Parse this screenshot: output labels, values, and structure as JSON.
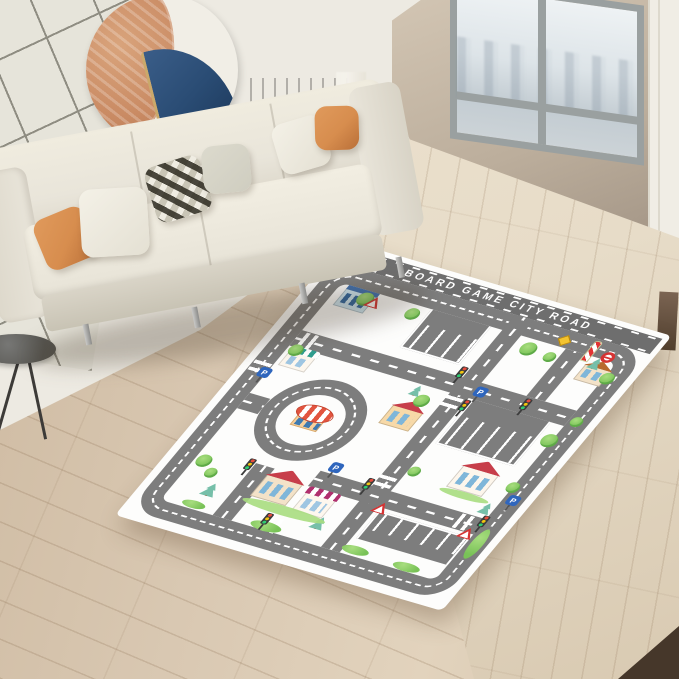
{
  "colors": {
    "wall": "#edeae2",
    "tile": "#e6e4da",
    "art_cream": "#f1eee6",
    "art_terracotta": "#c98a63",
    "art_navy": "#2a4c74",
    "marble": "#bcae9c",
    "window_frame": "#9aa0a0",
    "glass": "#dde4e8",
    "floor": "#d9c8b2",
    "floor_light": "#e7dcc8",
    "wood_dark": "#46372a",
    "sofa": "#e9e5da",
    "sofa_dark": "#d9d4c7",
    "pillow_orange": "#d78d4e",
    "pillow_gray": "#cfcdc0",
    "rug_bg": "#fdfdfc",
    "header": "#6e6e6e",
    "road": "#7d7d7d",
    "grass": "#79c257",
    "grass_light": "#a8dd7f",
    "sign_red": "#d63333",
    "sign_blue": "#2f66bd"
  },
  "rug": {
    "title": "BOARD GAME CITY ROAD",
    "items": [
      {
        "t": "car",
        "x": 14,
        "y": 9
      },
      {
        "t": "diamond",
        "x": 256,
        "y": 33
      },
      {
        "t": "pole",
        "x": 288,
        "y": 28
      },
      {
        "t": "noentry",
        "x": 304,
        "y": 36
      },
      {
        "t": "bldg",
        "x": 36,
        "y": 50,
        "w": 32,
        "h": 22
      },
      {
        "t": "shopA",
        "x": 32,
        "y": 132,
        "w": 28,
        "h": 20,
        "awn": "#2f9e8f"
      },
      {
        "t": "house",
        "x": 102,
        "y": 270,
        "w": 38,
        "h": 28,
        "roof": "#c73e4a",
        "body": "#f3e2c8"
      },
      {
        "t": "shopA",
        "x": 148,
        "y": 276,
        "w": 32,
        "h": 24,
        "awn": "#b0306e"
      },
      {
        "t": "house",
        "x": 160,
        "y": 158,
        "w": 32,
        "h": 24,
        "roof": "#c73e4a",
        "body": "#f7d9a8"
      },
      {
        "t": "house",
        "x": 264,
        "y": 200,
        "w": 38,
        "h": 28,
        "roof": "#c73e4a",
        "body": "#fdf6ec"
      },
      {
        "t": "house",
        "x": 296,
        "y": 56,
        "w": 28,
        "h": 20,
        "roof": "#b86a2e",
        "body": "#f3e2c8"
      },
      {
        "t": "zebraV",
        "x": 199,
        "y": 130,
        "w": 18,
        "h": 14
      },
      {
        "t": "zebraV",
        "x": 199,
        "y": 234,
        "w": 18,
        "h": 14
      },
      {
        "t": "zebraV",
        "x": 9,
        "y": 152,
        "w": 18,
        "h": 14
      },
      {
        "t": "zebraH",
        "x": 34,
        "y": 109,
        "w": 14,
        "h": 18
      },
      {
        "t": "zebraH",
        "x": 298,
        "y": 251,
        "w": 14,
        "h": 18
      },
      {
        "t": "zebraH",
        "x": 136,
        "y": 313,
        "w": 14,
        "h": 18
      },
      {
        "t": "tree",
        "x": 52,
        "y": 48,
        "s": 16
      },
      {
        "t": "tree",
        "x": 104,
        "y": 50,
        "s": 14
      },
      {
        "t": "tree",
        "x": 228,
        "y": 50,
        "s": 16
      },
      {
        "t": "tree",
        "x": 254,
        "y": 54,
        "s": 12
      },
      {
        "t": "tree",
        "x": 318,
        "y": 58,
        "s": 14
      },
      {
        "t": "tree",
        "x": 30,
        "y": 124,
        "s": 14
      },
      {
        "t": "tree",
        "x": 174,
        "y": 138,
        "s": 15
      },
      {
        "t": "tree",
        "x": 312,
        "y": 140,
        "s": 16
      },
      {
        "t": "tree",
        "x": 316,
        "y": 202,
        "s": 13
      },
      {
        "t": "tree",
        "x": 30,
        "y": 268,
        "s": 15
      },
      {
        "t": "tree",
        "x": 46,
        "y": 280,
        "s": 12
      },
      {
        "t": "tree",
        "x": 220,
        "y": 216,
        "s": 12
      },
      {
        "t": "tree",
        "x": 324,
        "y": 114,
        "s": 12
      },
      {
        "t": "pine",
        "x": 56,
        "y": 296,
        "w": 16,
        "h": 20
      },
      {
        "t": "pine",
        "x": 174,
        "y": 298,
        "w": 15,
        "h": 19
      },
      {
        "t": "pine",
        "x": 298,
        "y": 46,
        "w": 13,
        "h": 17
      },
      {
        "t": "pine",
        "x": 164,
        "y": 130,
        "w": 12,
        "h": 16
      },
      {
        "t": "pine",
        "x": 308,
        "y": 232,
        "w": 13,
        "h": 17
      },
      {
        "t": "bush",
        "x": 122,
        "y": 320,
        "w": 32,
        "h": 11
      },
      {
        "t": "bush",
        "x": 218,
        "y": 318,
        "w": 28,
        "h": 10
      },
      {
        "t": "bush",
        "x": 48,
        "y": 320,
        "w": 24,
        "h": 9
      },
      {
        "t": "bush",
        "x": 274,
        "y": 320,
        "w": 28,
        "h": 10
      },
      {
        "t": "bush",
        "x": 326,
        "y": 260,
        "w": 12,
        "h": 38
      },
      {
        "t": "grass",
        "x": 98,
        "y": 298,
        "w": 88,
        "h": 11
      },
      {
        "t": "grass",
        "x": 260,
        "y": 228,
        "w": 52,
        "h": 8
      },
      {
        "t": "tlight",
        "x": 192,
        "y": 96
      },
      {
        "t": "tlight",
        "x": 218,
        "y": 130
      },
      {
        "t": "tlight",
        "x": 192,
        "y": 242
      },
      {
        "t": "tlight",
        "x": 76,
        "y": 258
      },
      {
        "t": "tlight",
        "x": 318,
        "y": 246
      },
      {
        "t": "tlight",
        "x": 130,
        "y": 310
      },
      {
        "t": "tlight",
        "x": 270,
        "y": 110
      },
      {
        "t": "psign",
        "x": 20,
        "y": 158,
        "label": "P"
      },
      {
        "t": "psign",
        "x": 220,
        "y": 112,
        "label": "P"
      },
      {
        "t": "psign",
        "x": 326,
        "y": 216,
        "label": "P"
      },
      {
        "t": "psign",
        "x": 150,
        "y": 236,
        "label": "P"
      },
      {
        "t": "yield",
        "x": 62,
        "y": 50
      },
      {
        "t": "yield",
        "x": 216,
        "y": 264
      },
      {
        "t": "yield",
        "x": 308,
        "y": 264
      }
    ]
  }
}
